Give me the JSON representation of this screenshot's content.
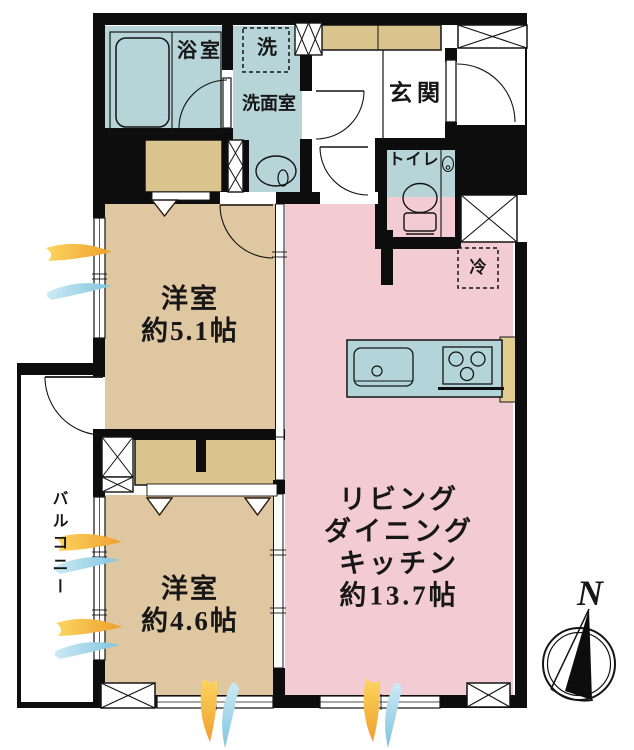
{
  "plan": {
    "bath": "浴室",
    "laundry": "洗",
    "washroom": "洗面室",
    "entrance": "玄関",
    "toilet": "トイレ",
    "refrigerator": "冷",
    "bedroom1_name": "洋室",
    "bedroom1_size": "約5.1帖",
    "bedroom2_name": "洋室",
    "bedroom2_size": "約4.6帖",
    "ldk_line1": "リビング",
    "ldk_line2": "ダイニング",
    "ldk_line3": "キッチン",
    "ldk_size": "約13.7帖",
    "balcony": "バルコニー",
    "compass_north": "N"
  },
  "colors": {
    "wet_area_blue": "#b7d4d8",
    "bedroom_tan": "#dfc7a1",
    "storage_tan": "#d9c48e",
    "ldk_pink": "#f2ccd2",
    "wall_black": "#0d0d0d",
    "wind_yellow": "#f3ae3d",
    "wind_blue": "#8ecfe6"
  }
}
